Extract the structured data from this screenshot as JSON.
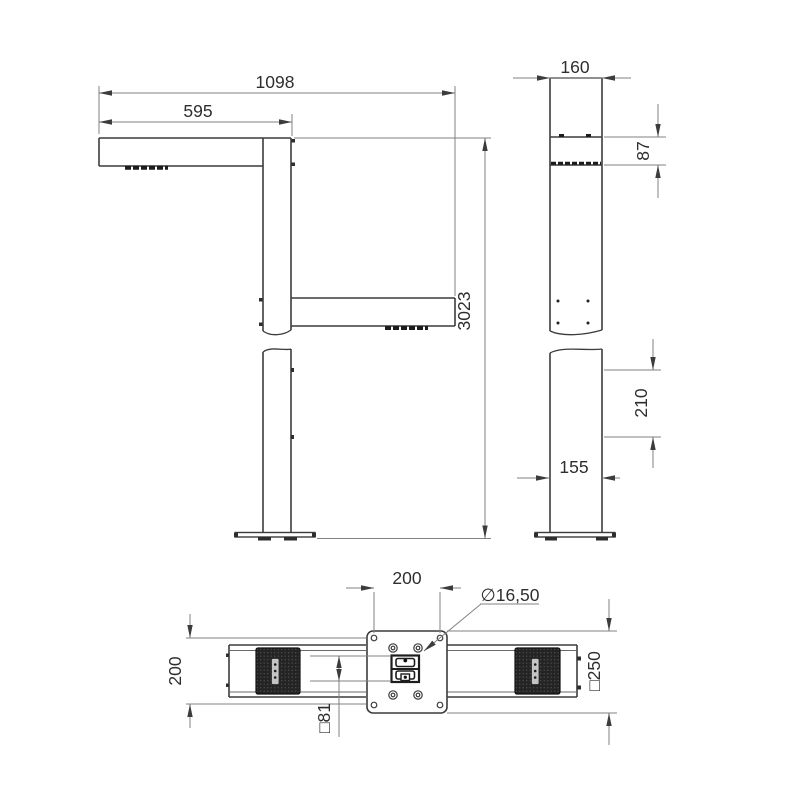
{
  "drawing": {
    "type": "technical-dimension-drawing",
    "views": {
      "front": "front elevation with cantilever arms and column",
      "side": "side elevation of column",
      "plan": "bottom/plan view of arm beam with mounting plate"
    }
  },
  "dims": {
    "front_total_width": "1098",
    "front_arm_length": "595",
    "front_total_height": "3023",
    "side_width_top": "160",
    "side_arm_thickness": "87",
    "side_adjustment_range": "210",
    "side_width_bottom": "155",
    "plan_hole_spacing_horizontal": "200",
    "plan_hole_diameter": "∅16,50",
    "plan_hole_spacing_vertical": "200",
    "plan_plate_size": "□250",
    "plan_tube_size": "□81"
  },
  "colors": {
    "background": "#ffffff",
    "object_line": "#3c3c3c",
    "dimension_line": "#828282",
    "text": "#2e2e2e",
    "pad_fill": "#242424",
    "slot_fill": "#c4c4c4"
  }
}
